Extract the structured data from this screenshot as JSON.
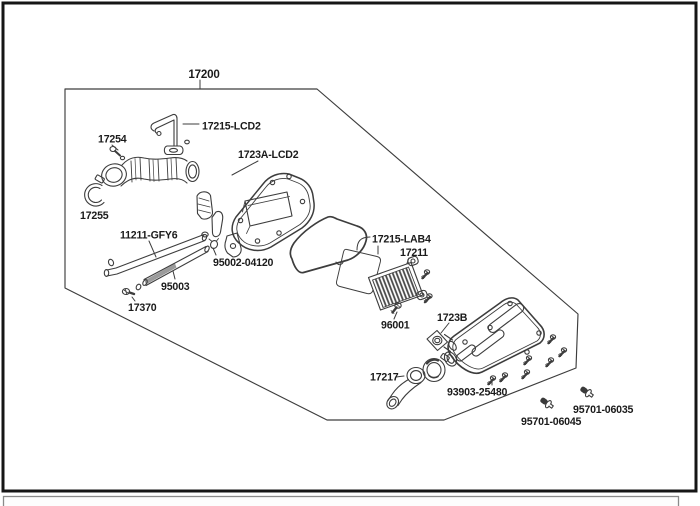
{
  "page": {
    "kind": "exploded-parts-diagram",
    "background": "#ffffff",
    "frame_color": "#161616",
    "line_color": "#3d3d3d",
    "text_color": "#1b1b1b",
    "footer_strip_color": "#8a8a8a"
  },
  "callouts": {
    "c17200": "17200",
    "c17215_lcd2": "17215-LCD2",
    "c17254": "17254",
    "c1723a_lcd2": "1723A-LCD2",
    "c17255": "17255",
    "c11211_gfy6": "11211-GFY6",
    "c95002_04120": "95002-04120",
    "c95003": "95003",
    "c17370": "17370",
    "c17215_lab4": "17215-LAB4",
    "c17211": "17211",
    "c96001": "96001",
    "c1723b": "1723B",
    "c17217": "17217",
    "c93903_25480": "93903-25480",
    "c95701_06045": "95701-06045",
    "c95701_06035": "95701-06035"
  }
}
